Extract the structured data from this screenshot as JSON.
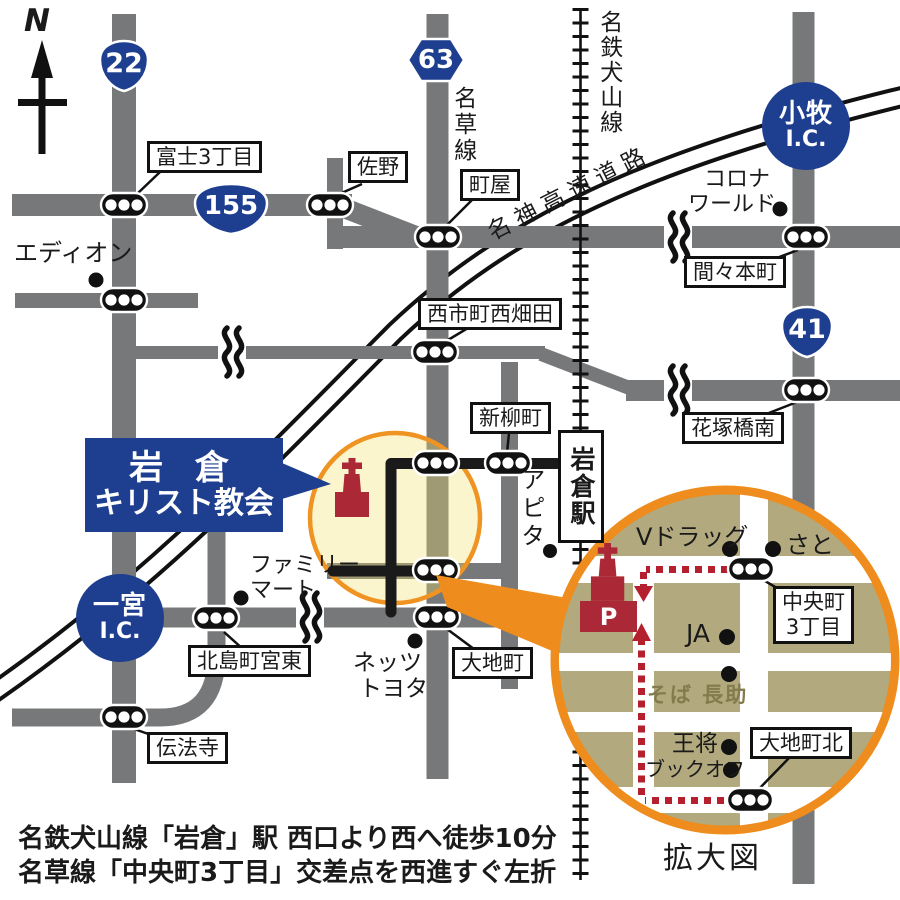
{
  "colors": {
    "road_gray": "#77787a",
    "route_black": "#1a1a1a",
    "shield_blue": "#1e3e90",
    "highlight_orange": "#ee8c1e",
    "highlight_yellow_fill": "rgba(244,226,102,0.33)",
    "inset_khaki": "#b2aa7e",
    "church_red": "#ab2936",
    "dashed_route_red": "#b5202f",
    "soba_text_olive": "#837a4d"
  },
  "compass": {
    "label": "N"
  },
  "routes": {
    "r22": "22",
    "r155": "155",
    "r63": "63",
    "r41": "41"
  },
  "lines": {
    "nagusa": "名草線",
    "meitetsu_inuyama": "名鉄犬山線",
    "meishin": "名神高速道路"
  },
  "station": {
    "iwakura": "岩倉駅"
  },
  "destination": {
    "line1": "岩 倉",
    "line2": "キリスト教会"
  },
  "interchanges": {
    "komaki": {
      "name": "小牧",
      "ic": "I.C."
    },
    "ichinomiya": {
      "name": "一宮",
      "ic": "I.C."
    }
  },
  "intersections": {
    "fuji3": "富士3丁目",
    "sano": "佐野",
    "machiya": "町屋",
    "mamahoncho": "間々本町",
    "nishiichicho_nishihatada": "西市町西畑田",
    "hanatsukabashi_minami": "花塚橋南",
    "shinyanagicho": "新柳町",
    "daichicho": "大地町",
    "kitajimacho_miyahigashi": "北島町宮東",
    "denboji": "伝法寺"
  },
  "pois": {
    "edion": "エディオン",
    "corona": {
      "line1": "コロナ",
      "line2": "ワールド"
    },
    "familymart": {
      "line1": "ファミリー",
      "line2": "マート"
    },
    "apita": "アピタ",
    "netz_toyota": {
      "line1": "ネッツ",
      "line2": "トヨタ"
    }
  },
  "inset": {
    "title": "拡大図",
    "parking": "P",
    "pois": {
      "vdrug": "Vドラッグ",
      "sato": "さと",
      "ja": "JA",
      "soba_chosuke": "そば 長助",
      "osho": "王将",
      "bookoff": "ブックオフ"
    },
    "intersections": {
      "chuocho": {
        "line1": "中央町",
        "line2": "3丁目"
      },
      "daichicho_kita": "大地町北"
    }
  },
  "footer": {
    "line1": "名鉄犬山線「岩倉」駅 西口より西へ徒歩10分",
    "line2": "名草線「中央町3丁目」交差点を西進すぐ左折"
  }
}
